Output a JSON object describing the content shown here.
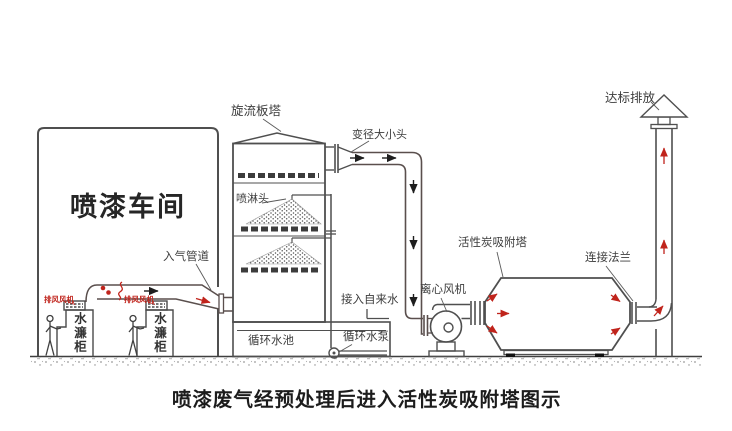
{
  "caption": "喷漆废气经预处理后进入活性炭吸附塔图示",
  "workshop": {
    "label": "喷漆车间"
  },
  "booths": {
    "cabinet_label": "水濂柜",
    "exhaust_fan_label": "排风风机"
  },
  "inlet_duct": {
    "label": "入气管道"
  },
  "scrubber": {
    "label": "旋流板塔",
    "spray_head_label": "喷淋头"
  },
  "reducer": {
    "label": "变径大小头"
  },
  "pool": {
    "label": "循环水池"
  },
  "pump": {
    "label": "循环水泵"
  },
  "tap_water": {
    "label": "接入自来水"
  },
  "fan": {
    "label": "离心风机"
  },
  "carbon_tower": {
    "label": "活性炭吸附塔"
  },
  "flange": {
    "label": "连接法兰"
  },
  "stack": {
    "label": "达标排放"
  },
  "colors": {
    "line": "#4f4f4f",
    "accent_red": "#c0241c",
    "text": "#3d3d3d"
  }
}
